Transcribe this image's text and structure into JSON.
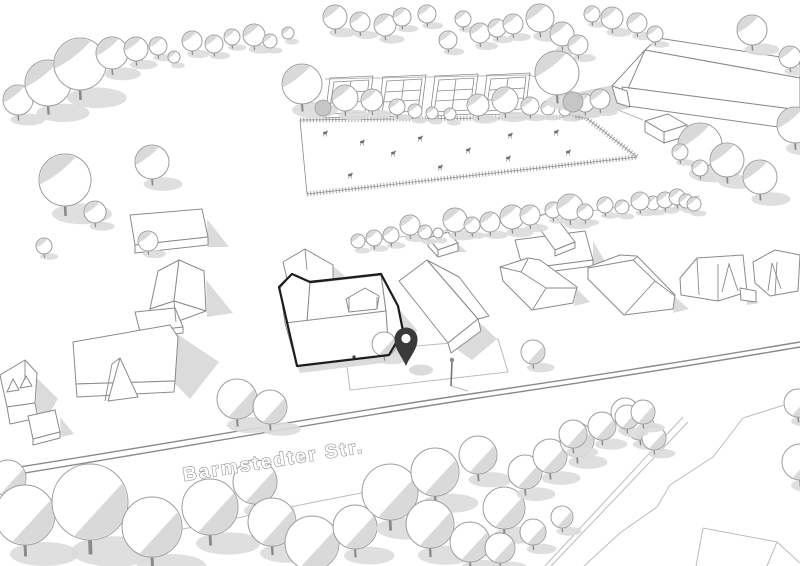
{
  "street": {
    "label": "Barmstedter Str."
  },
  "pin": {
    "name": "location-pin",
    "color": "#3a3a3a"
  },
  "colors": {
    "background": "#ffffff",
    "line": "#8a8a8a",
    "line_light": "#bcbcbc",
    "shadow": "#dbdbdb",
    "tree_stroke": "#9d9d9d",
    "tree_shade": "#cfcfcf",
    "highlight": "#1c1c1c",
    "fence": "#b0b0b0",
    "animal": "#6e6e6e"
  },
  "scene": {
    "curbs": [
      "M0,470 C150,447 320,416 470,394 C620,372 710,357 800,342",
      "M0,477 C150,453 320,422 472,399 C620,377 712,362 800,347"
    ],
    "faint": [
      "M345,352 L498,339 L508,372 L350,390 Z",
      "M110,544 L310,503 L432,479",
      "M800,400 L743,418 L713,457 L670,485 L657,507 L620,533 L584,566",
      "M683,417 L545,566",
      "M688,422 L551,566",
      "M703,528 L777,542 L800,563",
      "M777,542 L767,566",
      "M703,528 L696,566",
      "M325,79 L530,75 L643,120",
      "M355,243 L700,196",
      "M451,386 L468,391"
    ],
    "shadows": [
      "M560,96 L613,85 L630,108 L573,122 Z",
      "M687,127 L701,139 L687,140 Z",
      "M207,219 L229,247 L208,247 Z",
      "M206,280 L233,313 L207,317 Z",
      "M177,334 L219,362 L190,399 L175,384 Z",
      "M37,378 L58,399 L43,424 L36,406 Z",
      "M60,417 L74,434 L61,437 Z",
      "M478,321 L497,339 L472,360 L452,346 Z",
      "M577,289 L590,302 L574,306 Z",
      "M593,241 L606,263 L593,267 Z",
      "M675,297 L689,309 L673,313 Z",
      "M747,293 L759,303 L747,305 Z",
      "M398,308 L417,330 L409,357 L390,356 L403,331 Z",
      "M297,366 L389,355 L391,362 L300,373 Z",
      "M333,266 L345,276 L334,280 Z",
      "M458,244 L467,252 L458,252 Z"
    ],
    "faces": [
      "M645,50 L800,78 L800,60 L658,38 Z",
      "M645,50 L800,78 L800,110 L622,87 Z",
      "M612,86 L645,50 L627,91 Z",
      "M622,87 L800,110 L800,130 L628,106 Z",
      "M612,86 L627,91 L630,107 L617,103 Z",
      "M645,121 L668,114 L687,125 L664,132 Z",
      "M664,132 L687,125 L687,136 L664,143 Z",
      "M645,121 L664,132 L664,143 L645,132 Z",
      "M130,215 L202,209 L208,237 L135,245 Z",
      "M135,245 L208,237 L208,245 L135,253 Z",
      "M158,271 L179,260 L174,301 L150,309 Z",
      "M179,260 L204,271 L206,311 L174,301 Z",
      "M150,309 L174,301 L206,311 L176,322 L150,316 Z",
      "M135,312 L175,308 L183,327 L140,332 Z",
      "M140,332 L183,327 L183,333 L140,338 Z",
      "M73,342 L170,325 L178,337 L175,381 L76,384 Z",
      "M76,384 L175,381 L174,392 L77,397 Z",
      "M120,358 L138,397 L108,401 Z",
      "M0,375 L25,360 L37,373 L35,403 L7,407 Z",
      "M7,392 L13,379 L19,390 Z",
      "M20,388 L26,376 L32,386 Z",
      "M7,407 L35,403 L38,418 L10,424 Z",
      "M28,416 L55,410 L60,432 L33,439 Z",
      "M33,439 L60,432 L60,438 L33,445 Z",
      "M283,262 L305,249 L333,265 L333,279 L288,283 Z",
      "M280,288 L292,274 L310,282 L307,322 L285,323 Z",
      "M310,282 L381,274 L386,311 L307,322 Z",
      "M285,323 L386,311 L389,355 L297,366 Z",
      "M346,299 L365,288 L379,296 L377,309 L349,312 Z",
      "M381,274 L398,306 L403,331 L389,355 L386,311 Z",
      "M399,281 L427,260 L478,319 L448,343 Z",
      "M427,260 L459,277 L489,316 L478,319 Z",
      "M448,343 L478,319 L481,331 L451,353 Z",
      "M428,238 L448,232 L458,243 L438,250 Z",
      "M438,250 L458,243 L458,251 L438,257 Z",
      "M428,238 L438,250 L438,257 L428,246 Z",
      "M515,240 L585,231 L593,260 L523,269 Z",
      "M523,269 L593,260 L593,266 L523,275 Z",
      "M532,218 L552,212 L575,242 L555,250 Z",
      "M555,250 L575,242 L575,248 L555,256 Z",
      "M500,267 L528,258 L540,260 L577,287 L573,303 L532,310 L503,281 Z",
      "M588,267 L620,255 L637,256 L675,295 L673,309 L624,315 L588,279 Z",
      "M680,278 L697,258 L743,255 L747,292 L718,301 L681,295 Z",
      "M740,288 L756,291 L756,302 L741,300 Z",
      "M753,262 L775,250 L800,255 L798,291 L770,296 L755,283 Z"
    ],
    "details": [
      "M521,272 L546,288",
      "M500,267 L521,272",
      "M528,259 L521,272",
      "M577,288 L546,288",
      "M533,309 L546,288",
      "M633,260 L655,281",
      "M588,268 L633,260",
      "M637,257 L633,260",
      "M675,296 L655,281",
      "M625,314 L655,281",
      "M718,264 L718,301",
      "M722,292 L729,264 L738,291",
      "M697,259 L699,295",
      "M777,262 L775,295",
      "M768,291 L772,263 L781,289",
      "M305,249 L307,270",
      "M25,360 L25,380",
      "M120,358 L112,364 L105,401",
      "M174,301 L176,322",
      "M310,283 L381,275",
      "M349,297 L349,312",
      "M377,297 L377,309"
    ],
    "fence_ticked": [
      "M300,120 L585,117",
      "M585,117 L637,157",
      "M307,194 L637,157"
    ],
    "fence_plain": [
      "M300,120 L307,194"
    ],
    "allotment": {
      "offsets": [
        [
          0,
          0
        ],
        [
          53,
          -1
        ],
        [
          105,
          -2
        ],
        [
          157,
          -3
        ]
      ],
      "base": [
        "M330,78 L373,76 L368,116 L325,118 Z",
        "M334,82 L369,80 L365,112 L329,114 Z",
        "M333,93 L368,91",
        "M331,103 L366,101",
        "M351,81 L347,113"
      ]
    },
    "animals": [
      [
        325,
        133
      ],
      [
        362,
        142
      ],
      [
        393,
        153
      ],
      [
        420,
        138
      ],
      [
        440,
        167
      ],
      [
        468,
        150
      ],
      [
        508,
        158
      ],
      [
        510,
        135
      ],
      [
        556,
        132
      ],
      [
        568,
        152
      ],
      [
        350,
        175
      ]
    ],
    "trees": [
      [
        18,
        100,
        15
      ],
      [
        48,
        83,
        23
      ],
      [
        80,
        64,
        26
      ],
      [
        112,
        53,
        16
      ],
      [
        136,
        49,
        12
      ],
      [
        158,
        46,
        9
      ],
      [
        174,
        57,
        6
      ],
      [
        192,
        41,
        10
      ],
      [
        214,
        44,
        9
      ],
      [
        232,
        37,
        8
      ],
      [
        254,
        35,
        11
      ],
      [
        270,
        41,
        7
      ],
      [
        288,
        33,
        6
      ],
      [
        335,
        17,
        12
      ],
      [
        360,
        22,
        10
      ],
      [
        385,
        25,
        11
      ],
      [
        402,
        17,
        9
      ],
      [
        427,
        14,
        9
      ],
      [
        448,
        40,
        9
      ],
      [
        463,
        19,
        8
      ],
      [
        480,
        33,
        10
      ],
      [
        497,
        28,
        9
      ],
      [
        513,
        24,
        10
      ],
      [
        540,
        18,
        14
      ],
      [
        562,
        34,
        12
      ],
      [
        578,
        45,
        10
      ],
      [
        592,
        14,
        8
      ],
      [
        612,
        18,
        11
      ],
      [
        637,
        23,
        10
      ],
      [
        655,
        34,
        8
      ],
      [
        752,
        30,
        15
      ],
      [
        790,
        57,
        11
      ],
      [
        65,
        180,
        26
      ],
      [
        95,
        212,
        11
      ],
      [
        152,
        162,
        17
      ],
      [
        44,
        246,
        8
      ],
      [
        148,
        241,
        10
      ],
      [
        302,
        84,
        20
      ],
      [
        345,
        98,
        13
      ],
      [
        372,
        100,
        11
      ],
      [
        397,
        107,
        8
      ],
      [
        415,
        111,
        7
      ],
      [
        432,
        113,
        6
      ],
      [
        450,
        114,
        6
      ],
      [
        478,
        105,
        11
      ],
      [
        505,
        100,
        13
      ],
      [
        530,
        106,
        9
      ],
      [
        548,
        108,
        7
      ],
      [
        565,
        110,
        6
      ],
      [
        557,
        73,
        22
      ],
      [
        585,
        103,
        9
      ],
      [
        600,
        99,
        10
      ],
      [
        700,
        145,
        22
      ],
      [
        727,
        160,
        17
      ],
      [
        760,
        177,
        17
      ],
      [
        680,
        152,
        8
      ],
      [
        700,
        168,
        8
      ],
      [
        795,
        125,
        18
      ],
      [
        653,
        203,
        7
      ],
      [
        665,
        200,
        8
      ],
      [
        677,
        197,
        8
      ],
      [
        686,
        201,
        7
      ],
      [
        694,
        204,
        7
      ],
      [
        358,
        241,
        7
      ],
      [
        374,
        238,
        8
      ],
      [
        391,
        235,
        8
      ],
      [
        410,
        225,
        10
      ],
      [
        425,
        232,
        7
      ],
      [
        438,
        233,
        5
      ],
      [
        455,
        220,
        12
      ],
      [
        472,
        225,
        8
      ],
      [
        490,
        222,
        10
      ],
      [
        512,
        217,
        12
      ],
      [
        530,
        215,
        10
      ],
      [
        553,
        210,
        8
      ],
      [
        570,
        207,
        13
      ],
      [
        585,
        212,
        8
      ],
      [
        605,
        205,
        8
      ],
      [
        622,
        207,
        7
      ],
      [
        640,
        201,
        9
      ],
      [
        237,
        399,
        20
      ],
      [
        270,
        407,
        17
      ],
      [
        533,
        352,
        12
      ],
      [
        384,
        344,
        12
      ],
      [
        8,
        478,
        18
      ],
      [
        25,
        515,
        30
      ],
      [
        90,
        502,
        38
      ],
      [
        152,
        527,
        30
      ],
      [
        210,
        507,
        28
      ],
      [
        255,
        482,
        22
      ],
      [
        272,
        522,
        24
      ],
      [
        312,
        543,
        27
      ],
      [
        355,
        527,
        22
      ],
      [
        390,
        492,
        28
      ],
      [
        435,
        472,
        24
      ],
      [
        478,
        455,
        19
      ],
      [
        430,
        524,
        24
      ],
      [
        470,
        542,
        20
      ],
      [
        504,
        508,
        21
      ],
      [
        525,
        472,
        17
      ],
      [
        550,
        456,
        17
      ],
      [
        577,
        440,
        17
      ],
      [
        602,
        426,
        14
      ],
      [
        625,
        412,
        14
      ],
      [
        573,
        434,
        14
      ],
      [
        640,
        426,
        14
      ],
      [
        654,
        438,
        12
      ],
      [
        500,
        548,
        15
      ],
      [
        533,
        532,
        13
      ],
      [
        562,
        517,
        11
      ],
      [
        798,
        403,
        14
      ],
      [
        800,
        462,
        18
      ],
      [
        627,
        417,
        12
      ],
      [
        643,
        412,
        12
      ]
    ],
    "gray_trees": [
      [
        323,
        108,
        8
      ],
      [
        573,
        102,
        10
      ]
    ],
    "bold": [
      "M279,287 L292,274 L310,282 L381,274 L398,306 L403,331 L389,355 L297,366 Z"
    ],
    "marks": [
      [
        354,
        357,
        1.6
      ]
    ],
    "lamp": {
      "pole": "M452,362 L451,386",
      "head": [
        452,
        360,
        2.2
      ]
    }
  }
}
